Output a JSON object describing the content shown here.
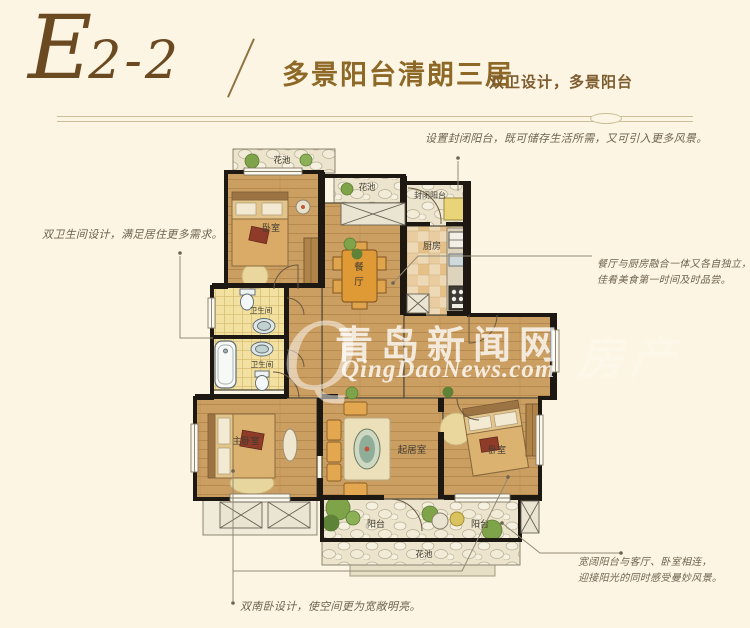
{
  "header": {
    "unit_e": "E",
    "unit_rest": "2-2",
    "title": "多景阳台清朗三居",
    "subtitle": "双卫设计，多景阳台"
  },
  "annotations": {
    "top": "设置封闭阳台，既可储存生活所需，又可引入更多风景。",
    "left": "双卫生间设计，满足居住更多需求。",
    "right": [
      "餐厅与厨房融合一体又各自独立，",
      "佳肴美食第一时间及时品尝。"
    ],
    "bottom_right": [
      "宽阔阳台与客厅、卧室相连，",
      "迎接阳光的同时感受曼妙风景。"
    ],
    "bottom": "双南卧设计，使空间更为宽敞明亮。"
  },
  "rooms": {
    "flower_bed_top": "花池",
    "bedroom_top": "卧室",
    "flower_bed_mid": "花池",
    "enclosed_balcony": "封闭阳台",
    "kitchen": "厨房",
    "dining": [
      "餐",
      "厅"
    ],
    "bathroom_upper": "卫生间",
    "bathroom_lower": "卫生间",
    "master_bedroom": "主卧室",
    "living_room": "起居室",
    "bedroom_right": "卧室",
    "balcony_left": "阳台",
    "balcony_right": "阳台",
    "flower_bed_bottom": "花池"
  },
  "watermark": {
    "mark": "Q",
    "cn": "青岛新闻网",
    "en": "QingDaoNews.com",
    "suffix": "房产"
  },
  "colors": {
    "background": "#fcf5e3",
    "brand_brown": "#6b4a22",
    "title_gold": "#8d6827",
    "annotation_text": "#6e6450",
    "wall": "#1d1812"
  }
}
